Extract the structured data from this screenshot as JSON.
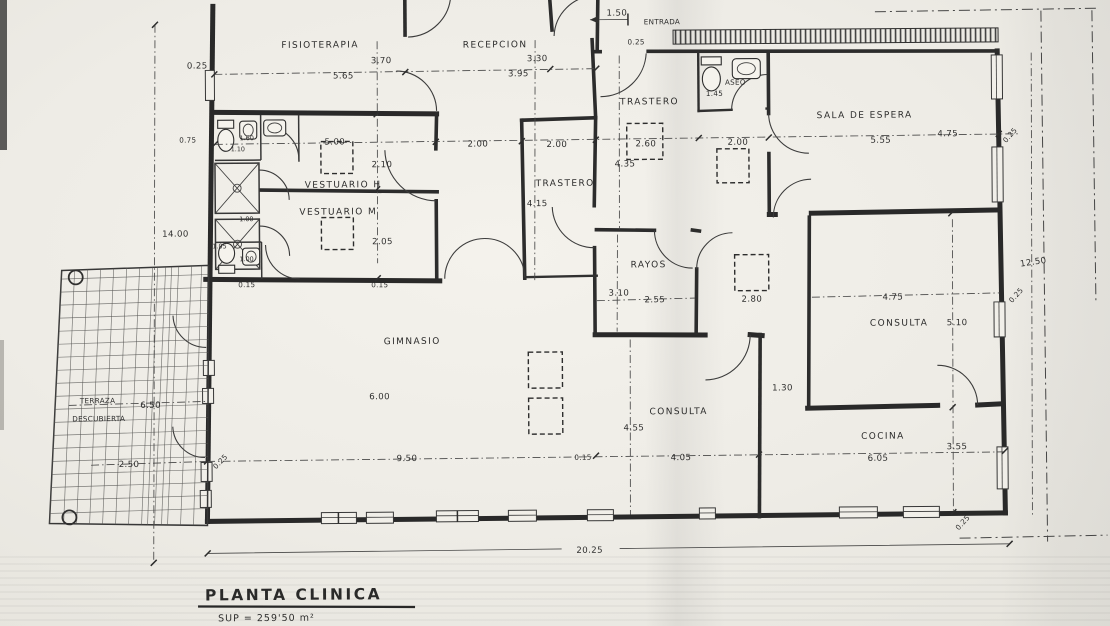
{
  "rooms": {
    "fisioterapia": "FISIOTERAPIA",
    "recepcion": "RECEPCION",
    "entrada": "ENTRADA",
    "trastero_top": "TRASTERO",
    "aseo": "ASEO",
    "sala_de_espera": "SALA DE ESPERA",
    "vestuario_h": "VESTUARIO H",
    "vestuario_m": "VESTUARIO M",
    "trastero_centro": "TRASTERO",
    "rayos": "RAYOS",
    "gimnasio": "GIMNASIO",
    "consulta_centro": "CONSULTA",
    "consulta_derecha": "CONSULTA",
    "cocina": "COCINA",
    "terraza_line1": "TERRAZA",
    "terraza_line2": "DESCUBIERTA"
  },
  "dims": {
    "muro_sup_izq": "0.25",
    "fisioterapia_ancho": "5.65",
    "fisioterapia_alto": "3.70",
    "recepcion_ancho": "3.95",
    "recepcion_alto": "3.30",
    "entrada_ancho": "1.50",
    "entrada_muro": "0.25",
    "aseo_alto": "1.45",
    "sala_ancho": "5.55",
    "sala_alto": "4.75",
    "muro_derecho_sup": "0.25",
    "vestuario_ancho": "5.00",
    "vestuario_h_alto": "2.10",
    "vestuario_m_alto": "2.05",
    "pasillo_1": "2.00",
    "pasillo_2": "2.00",
    "trastero_sup_ancho": "2.60",
    "trastero_sup_alto": "4.35",
    "pasillo_3": "2.00",
    "trastero_centro_alto": "4.15",
    "rayos_alto": "3.10",
    "rayos_ancho": "2.55",
    "pilar_hall": "2.80",
    "gimnasio_alto": "6.00",
    "gimnasio_ancho": "9.50",
    "muro_izq_inf": "0.25",
    "tabique_gimnasio": "0.15",
    "consulta_centro_alto": "4.55",
    "consulta_centro_ancho": "4.05",
    "paso_consulta": "1.30",
    "consulta_dcha_ancho": "4.75",
    "consulta_dcha_alto": "5.10",
    "fachada_derecha": "12.50",
    "muro_derecho_med": "0.25",
    "cocina_ancho": "6.05",
    "cocina_alto": "3.55",
    "muro_inf_dcho": "0.25",
    "terraza_ancho": "6.50",
    "terraza_fondo": "2.50",
    "fachada_izquierda": "14.00",
    "muro_izquierdo": "0.75",
    "fachada_inferior": "20.25",
    "tabique_vestuario_1": "0.15",
    "tabique_vestuario_2": "0.15",
    "aseo_vest_1": "1.60",
    "aseo_vest_2": "1.10",
    "ducha_1": "1.00",
    "ducha_2": "1.00",
    "aseo_vest_3": "1.05"
  },
  "title_block": {
    "title": "PLANTA CLINICA",
    "superficie": "SUP = 259'50 m²",
    "linea_parcial": "22'20"
  }
}
